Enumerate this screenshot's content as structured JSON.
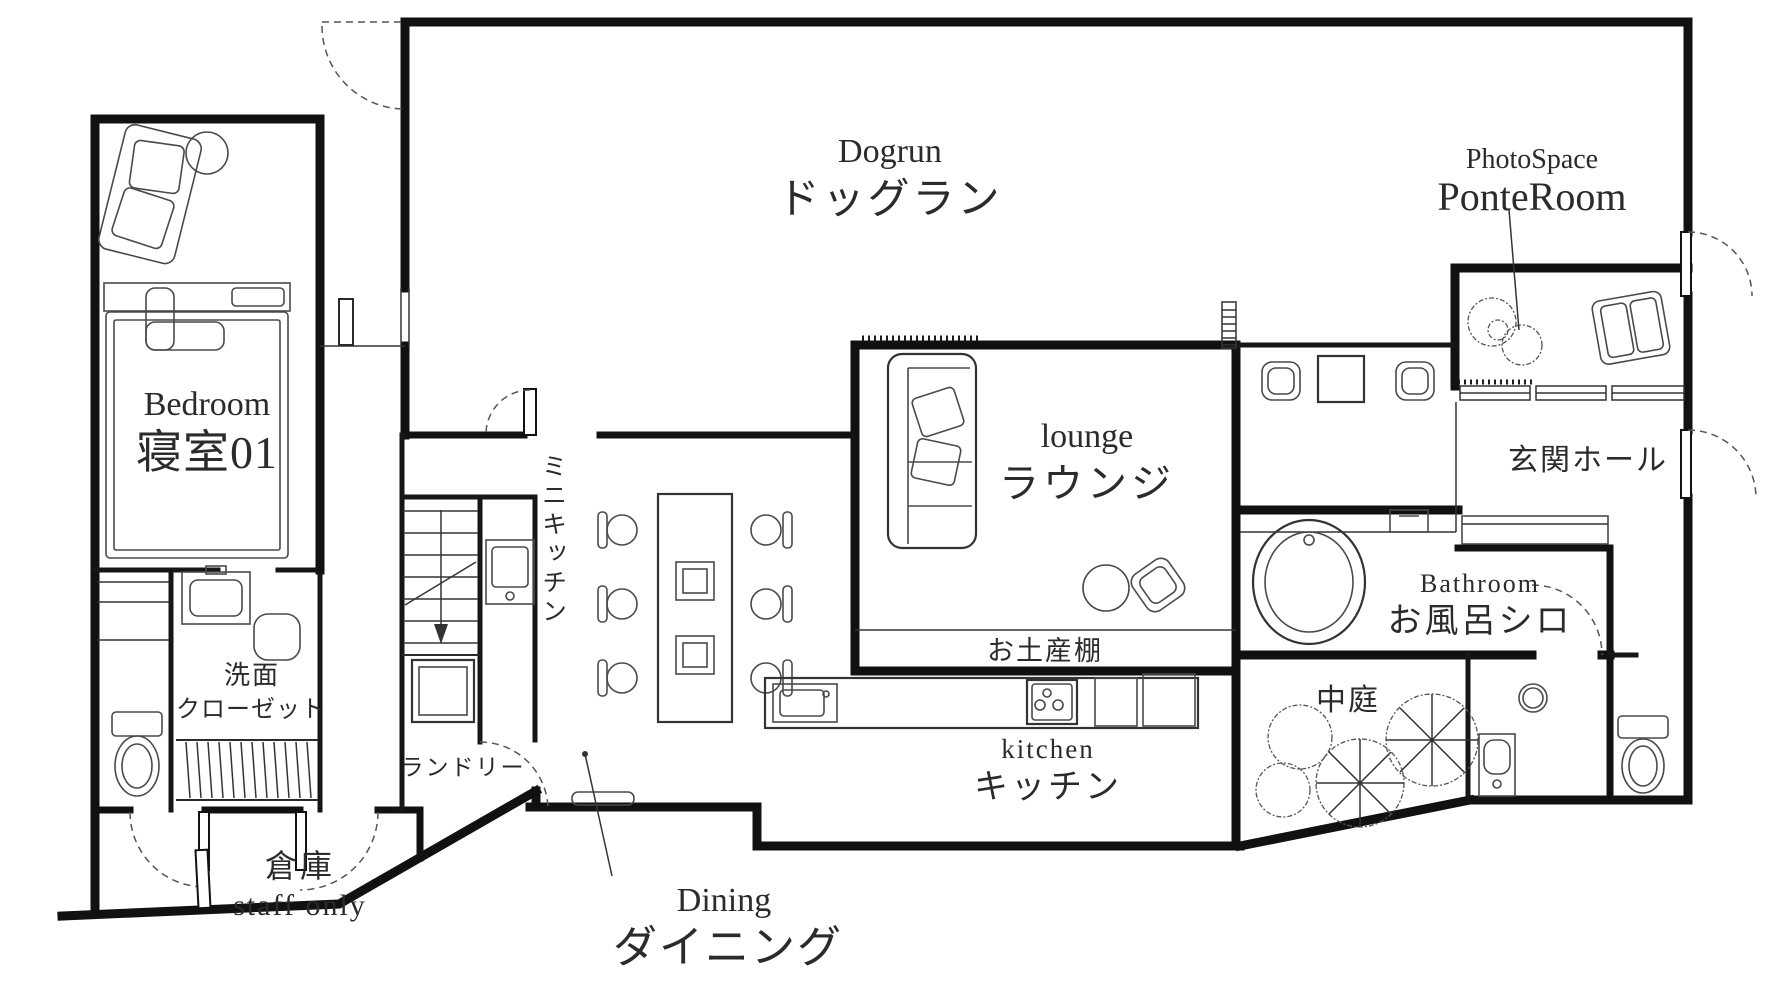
{
  "plan": {
    "rooms": {
      "dogrun": {
        "en": "Dogrun",
        "ja": "ドッグラン"
      },
      "photospace": {
        "en": "PhotoSpace",
        "name": "PonteRoom"
      },
      "bedroom": {
        "en": "Bedroom",
        "ja": "寝室01"
      },
      "lounge": {
        "en": "lounge",
        "ja": "ラウンジ"
      },
      "entrance_hall": {
        "ja": "玄関ホール"
      },
      "bathroom": {
        "en": "Bathroom",
        "ja": "お風呂シロ"
      },
      "souvenir_shelf": {
        "ja": "お土産棚"
      },
      "kitchen": {
        "en": "kitchen",
        "ja": "キッチン"
      },
      "courtyard": {
        "ja": "中庭"
      },
      "mini_kitchen": {
        "ja": "ミニキッチン"
      },
      "laundry": {
        "ja": "ランドリー"
      },
      "washroom_closet": {
        "line1": "洗面",
        "line2": "クローゼット"
      },
      "storage": {
        "ja": "倉庫",
        "en": "staff only"
      },
      "dining": {
        "en": "Dining",
        "ja": "ダイニング"
      }
    },
    "colors": {
      "wall": "#111111",
      "furniture": "#4a4a4a",
      "text": "#2b2b2b",
      "background": "#ffffff"
    }
  }
}
